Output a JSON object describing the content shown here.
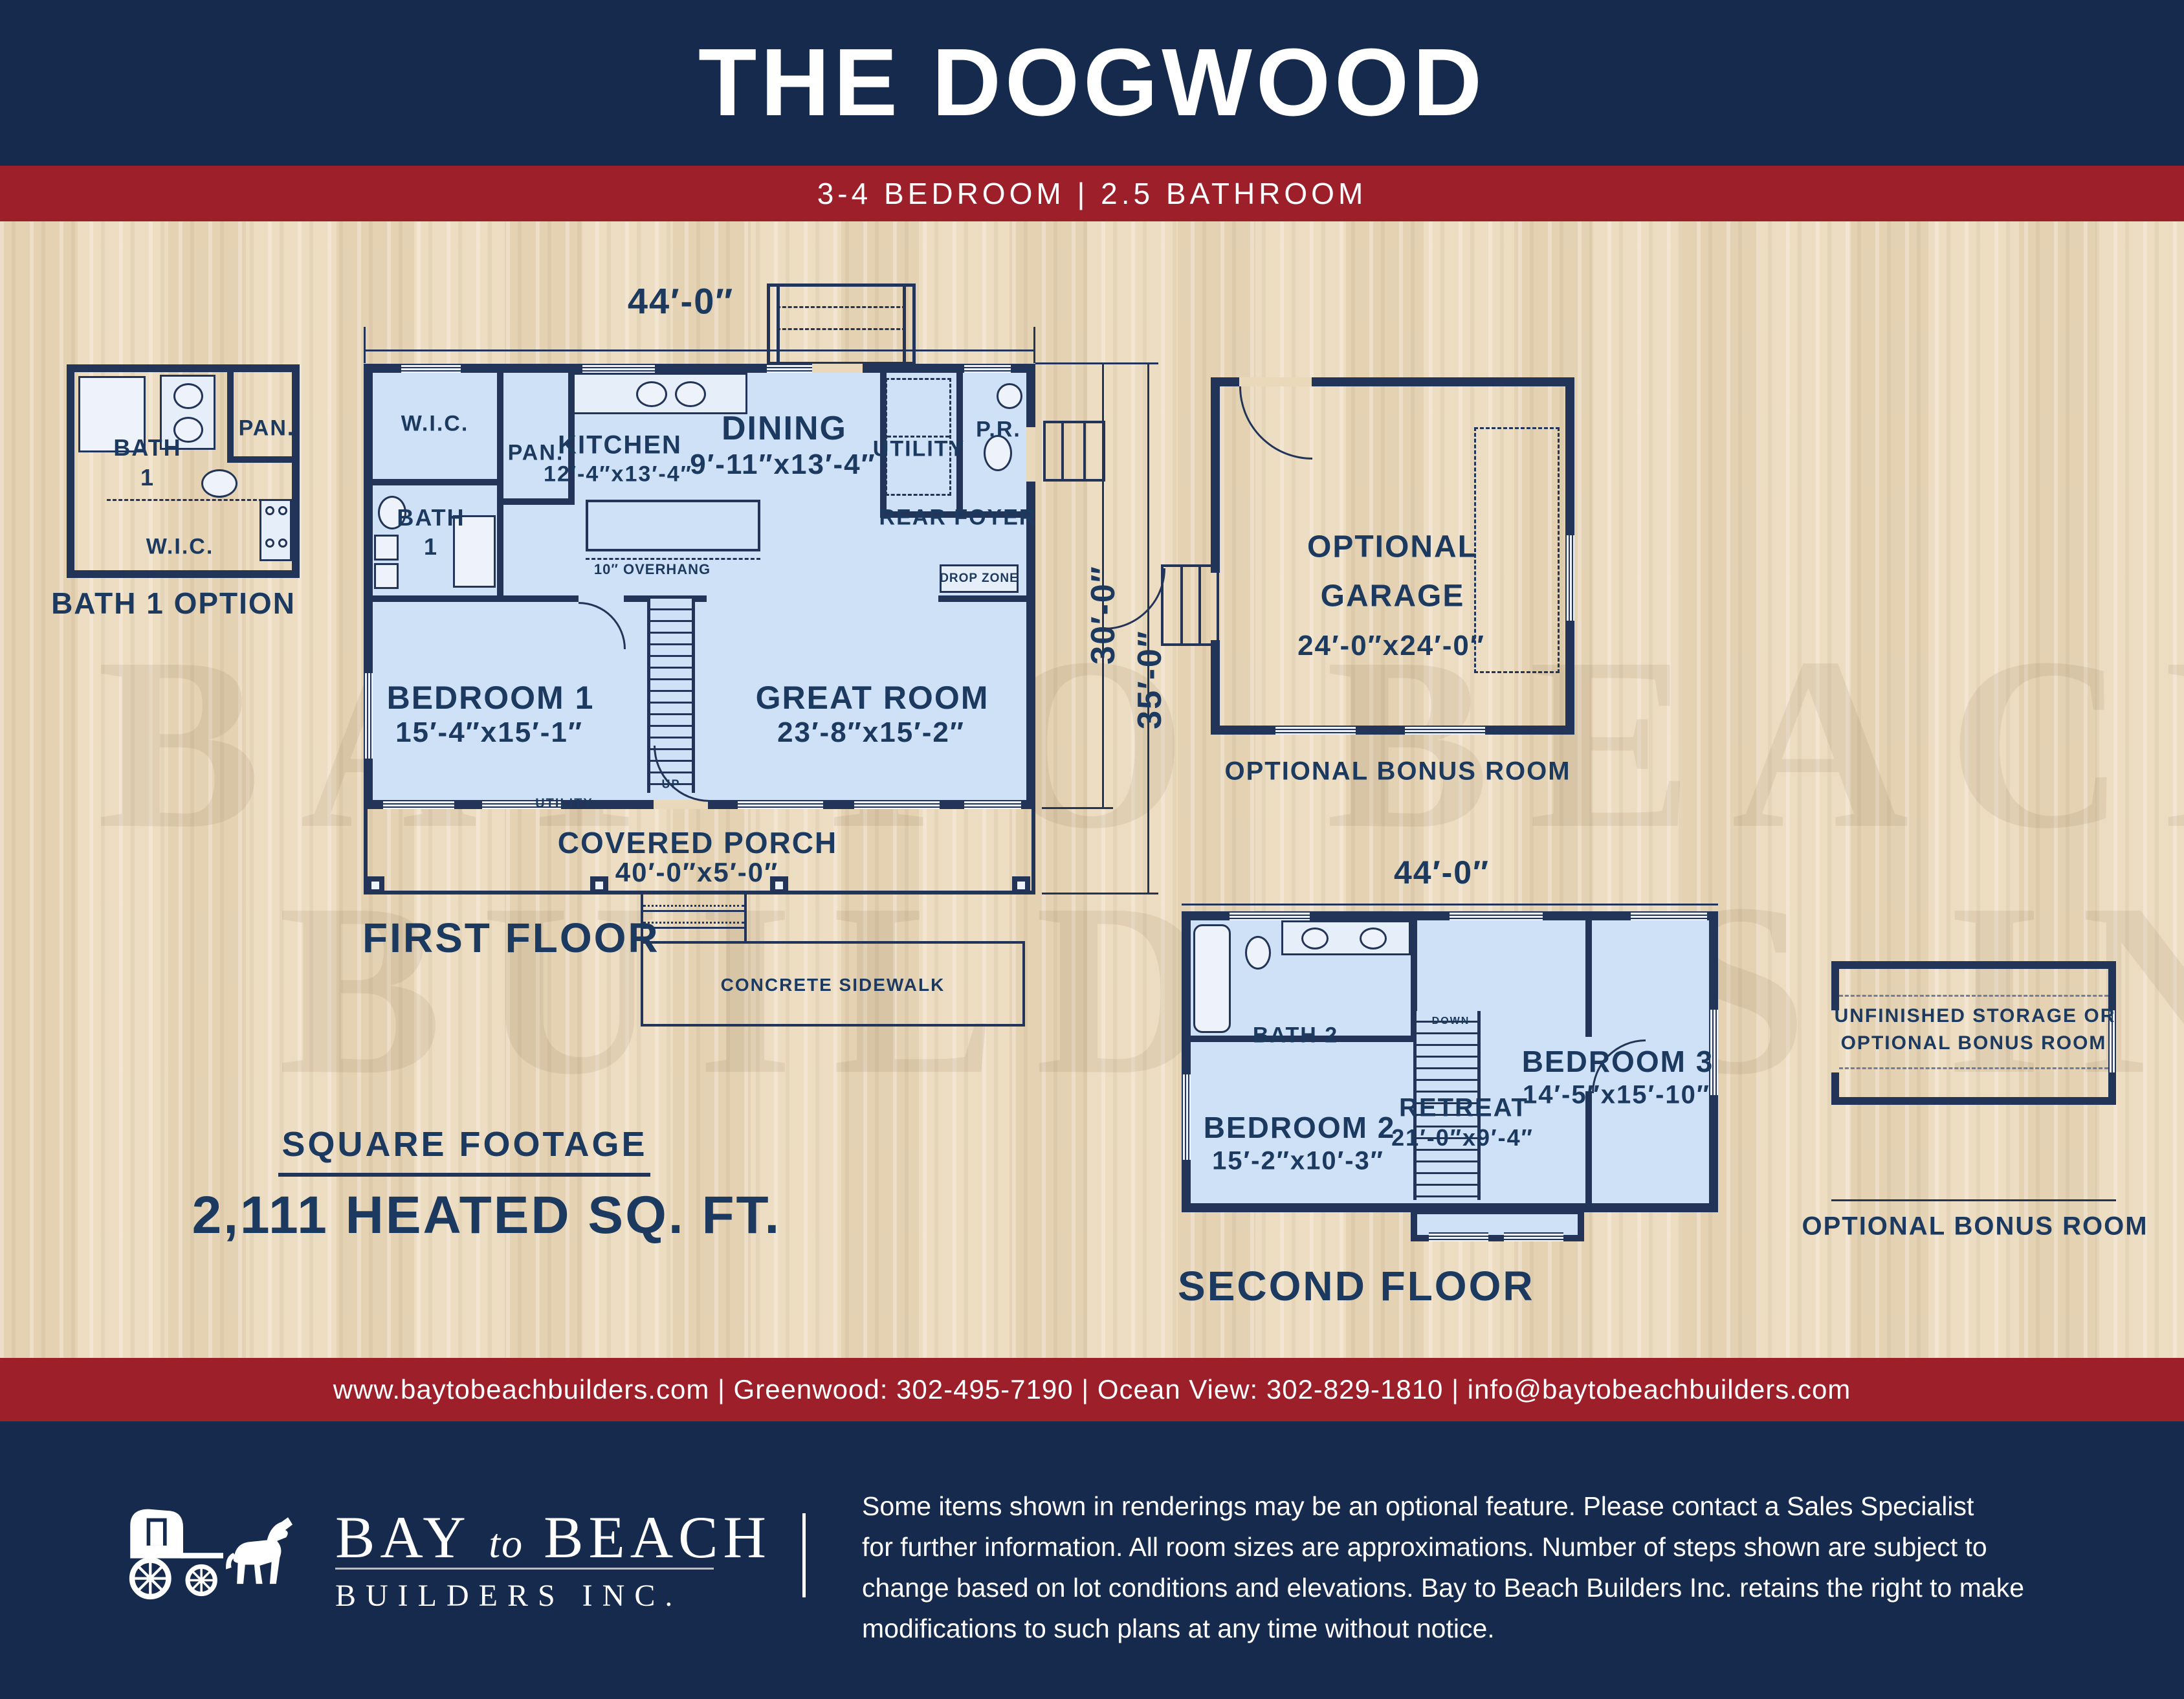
{
  "colors": {
    "navy": "#152a4c",
    "red": "#9c1f2a",
    "wood": "#ead8ba",
    "plan_fill": "#cfe1f6",
    "wall": "#223558",
    "ink": "#1c3a5f"
  },
  "header": {
    "title": "THE DOGWOOD",
    "subtitle": "3-4 BEDROOM | 2.5 BATHROOM"
  },
  "watermark": {
    "line1": "BAY TO BEACH",
    "line2": "BUILDERS INC."
  },
  "first_floor": {
    "dim_width": "44′-0″",
    "dim_depth_inner": "30′-0″",
    "dim_depth_outer": "35′-0″",
    "label": "FIRST FLOOR",
    "wic": "W.I.C.",
    "pan": "PAN.",
    "kitchen": {
      "name": "KITCHEN",
      "dims": "12′-4″x13′-4″"
    },
    "dining": {
      "name": "DINING",
      "dims": "9′-11″x13′-4″"
    },
    "utility": "UTILITY",
    "pr": "P.R.",
    "bath": {
      "line1": "BATH",
      "line2": "1"
    },
    "rear_foyer": "REAR FOYER",
    "drop_zone": "DROP ZONE",
    "overhang": "10″ OVERHANG",
    "bedroom1": {
      "name": "BEDROOM 1",
      "dims": "15′-4″x15′-1″"
    },
    "great_room": {
      "name": "GREAT ROOM",
      "dims": "23′-8″x15′-2″"
    },
    "up": "UP",
    "utility_small": "UTILITY",
    "porch": {
      "name": "COVERED PORCH",
      "dims": "40′-0″x5′-0″"
    },
    "sidewalk": "CONCRETE SIDEWALK"
  },
  "bath_option": {
    "bath": {
      "line1": "BATH",
      "line2": "1"
    },
    "pan": "PAN.",
    "wic": "W.I.C.",
    "label": "BATH 1 OPTION"
  },
  "garage": {
    "line1": "OPTIONAL",
    "line2": "GARAGE",
    "dims": "24′-0″x24′-0″",
    "bonus": "OPTIONAL BONUS ROOM"
  },
  "second_floor": {
    "dim_width": "44′-0″",
    "label": "SECOND FLOOR",
    "bath2": "BATH 2",
    "bedroom2": {
      "name": "BEDROOM 2",
      "dims": "15′-2″x10′-3″"
    },
    "retreat": {
      "name": "RETREAT",
      "dims": "21′-0″x9′-4″"
    },
    "bedroom3": {
      "name": "BEDROOM 3",
      "dims": "14′-5″x15′-10″"
    },
    "down": "DOWN"
  },
  "storage": {
    "line1": "UNFINISHED STORAGE OR",
    "line2": "OPTIONAL BONUS ROOM",
    "bonus": "OPTIONAL BONUS ROOM"
  },
  "square_footage": {
    "title": "SQUARE FOOTAGE",
    "value": "2,111 HEATED SQ. FT."
  },
  "contact": {
    "text": "www.baytobeachbuilders.com | Greenwood: 302-495-7190 | Ocean View: 302-829-1810 | info@baytobeachbuilders.com"
  },
  "footer": {
    "brand_a": "BAY",
    "brand_to": "to",
    "brand_b": "BEACH",
    "brand_line2": "BUILDERS INC.",
    "disclaimer_lines": [
      "Some items shown in renderings may be an optional feature. Please contact a Sales Specialist",
      "for further information. All room sizes are approximations. Number of steps shown are subject to",
      "change based on lot conditions and elevations. Bay to Beach Builders Inc. retains the right to make",
      "modifications to such plans at any time without notice."
    ]
  }
}
